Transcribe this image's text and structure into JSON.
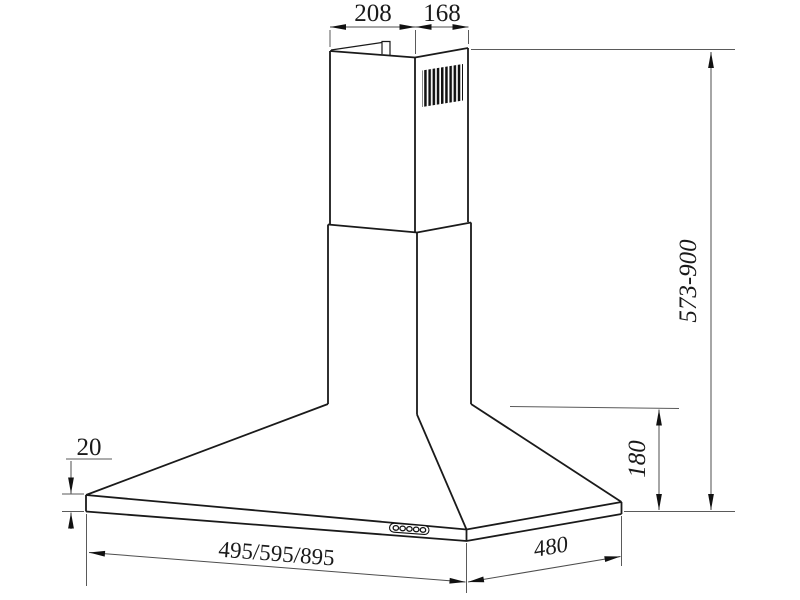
{
  "drawing": {
    "labels": {
      "chimney_top_width": "208",
      "chimney_top_depth": "168",
      "total_height_range": "573-900",
      "canopy_height": "180",
      "base_rim_thickness": "20",
      "hood_width_options": "495/595/895",
      "hood_depth": "480"
    },
    "colors": {
      "background": "#ffffff",
      "object_line": "#1a1a1a",
      "dimension_line": "#4d4d4d",
      "label_text": "#1a1a1a",
      "grille_fill": "#111111"
    }
  }
}
